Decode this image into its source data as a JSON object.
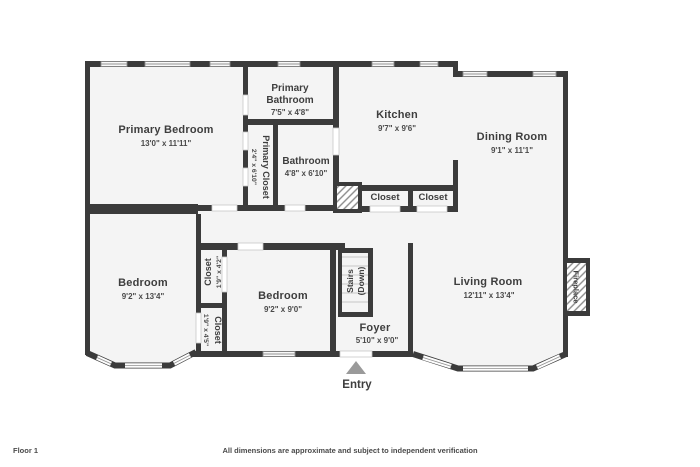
{
  "floor_plan": {
    "rooms": {
      "primary_bedroom": {
        "name": "Primary Bedroom",
        "dims": "13'0\" x 11'11\""
      },
      "primary_bathroom": {
        "name_line1": "Primary",
        "name_line2": "Bathroom",
        "dims": "7'5\" x 4'8\""
      },
      "primary_closet": {
        "name": "Primary Closet",
        "dims": "2'4\" x 6'10\""
      },
      "bathroom": {
        "name": "Bathroom",
        "dims": "4'8\" x 6'10\""
      },
      "kitchen": {
        "name": "Kitchen",
        "dims": "9'7\" x 9'6\""
      },
      "dining_room": {
        "name": "Dining Room",
        "dims": "9'1\" x 11'1\""
      },
      "closet_kitchen_1": {
        "name": "Closet"
      },
      "closet_kitchen_2": {
        "name": "Closet"
      },
      "bedroom_left": {
        "name": "Bedroom",
        "dims": "9'2\" x 13'4\""
      },
      "bedroom_middle": {
        "name": "Bedroom",
        "dims": "9'2\" x 9'0\""
      },
      "closet_upper": {
        "name": "Closet",
        "dims": "1'9\" x 4'2\""
      },
      "closet_lower": {
        "name": "Closet",
        "dims": "1'9\" x 4'5\""
      },
      "stairs": {
        "line1": "Stairs",
        "line2": "(Down)"
      },
      "foyer": {
        "name": "Foyer",
        "dims": "5'10\" x 9'0\""
      },
      "living_room": {
        "name": "Living Room",
        "dims": "12'11\" x 13'4\""
      },
      "fireplace": {
        "name": "Fireplace"
      }
    },
    "entry_label": "Entry",
    "colors": {
      "wall": "#3b3b3b",
      "room_fill": "#f4f4f4",
      "text": "#3e3e3e",
      "window_line": "#8f8f8f",
      "entry_arrow": "#9a9a9a"
    }
  },
  "footer": {
    "floor_label": "Floor 1",
    "disclaimer": "All dimensions are approximate and subject to independent verification"
  }
}
